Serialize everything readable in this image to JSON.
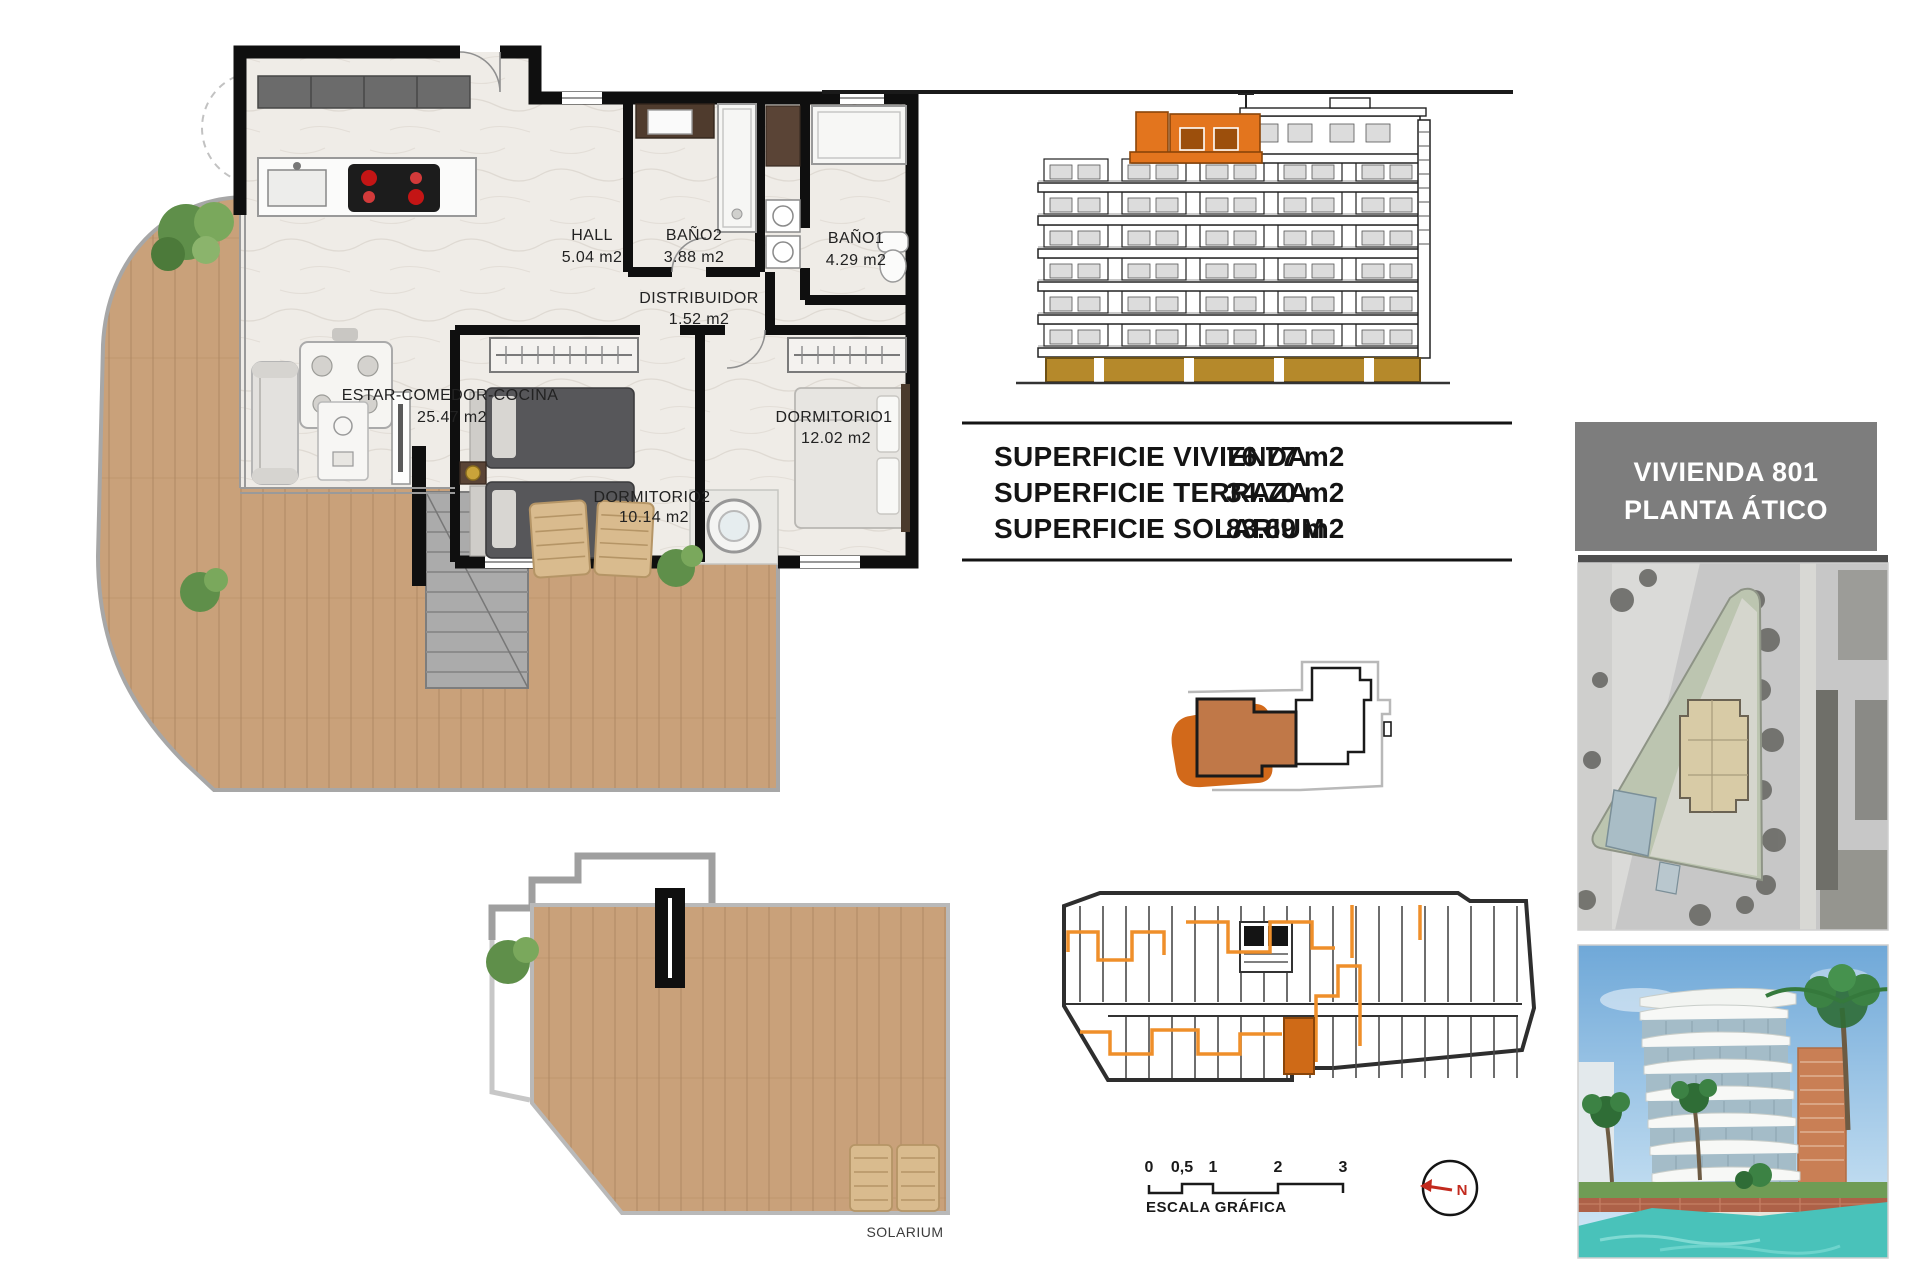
{
  "floor_plan": {
    "rooms": [
      {
        "name": "ESTAR-COMEDOR-COCINA",
        "area": "25.47 m2"
      },
      {
        "name": "HALL",
        "area": "5.04 m2"
      },
      {
        "name": "BAÑO2",
        "area": "3.88 m2"
      },
      {
        "name": "BAÑO1",
        "area": "4.29 m2"
      },
      {
        "name": "DISTRIBUIDOR",
        "area": "1.52 m2"
      },
      {
        "name": "DORMITORIO2",
        "area": "10.14 m2"
      },
      {
        "name": "DORMITORIO1",
        "area": "12.02 m2"
      }
    ],
    "solarium_label": "SOLARIUM"
  },
  "summary_table": {
    "rows": [
      {
        "label": "SUPERFICIE VIVIENDA",
        "value": "76.77 m2"
      },
      {
        "label": "SUPERFICIE TERRAZA",
        "value": "34.70 m2"
      },
      {
        "label": "SUPERFICIE SOLARIUM",
        "value": "83.69 m2"
      }
    ]
  },
  "unit_badge": {
    "line1": "VIVIENDA 801",
    "line2": "PLANTA ÁTICO"
  },
  "scale_bar": {
    "ticks": [
      "0",
      "0,5",
      "1",
      "2",
      "3"
    ],
    "label": "ESCALA GRÁFICA"
  },
  "compass": {
    "north_label": "N"
  },
  "colors": {
    "highlight_orange": "#e3751e",
    "route_orange": "#ef8f2a",
    "base_ochre": "#b5892b",
    "badge_gray": "#7d7d7d",
    "deck_wood": "#c9a17a"
  }
}
